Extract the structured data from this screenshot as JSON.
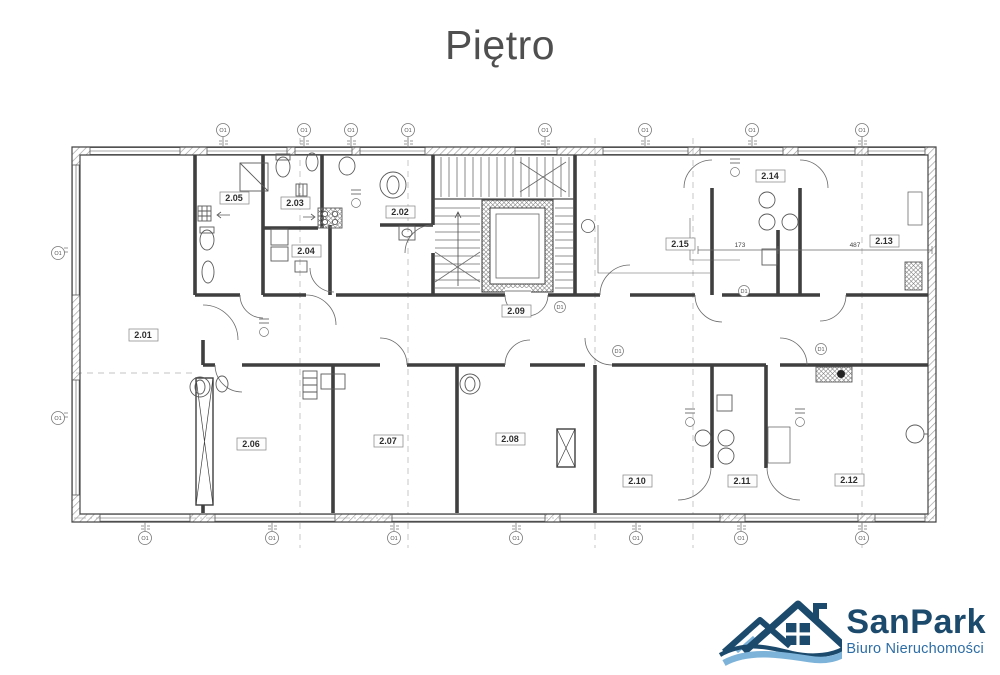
{
  "page": {
    "title": "Piętro"
  },
  "plan": {
    "rooms": [
      {
        "id": "2.01"
      },
      {
        "id": "2.02"
      },
      {
        "id": "2.03"
      },
      {
        "id": "2.04"
      },
      {
        "id": "2.05"
      },
      {
        "id": "2.06"
      },
      {
        "id": "2.07"
      },
      {
        "id": "2.08"
      },
      {
        "id": "2.09"
      },
      {
        "id": "2.10"
      },
      {
        "id": "2.11"
      },
      {
        "id": "2.12"
      },
      {
        "id": "2.13"
      },
      {
        "id": "2.14"
      },
      {
        "id": "2.15"
      }
    ],
    "window_markers_top": [
      "O1",
      "O1",
      "O1",
      "O1",
      "O1",
      "O1",
      "O1",
      "O1"
    ],
    "window_markers_bottom": [
      "O1",
      "O1",
      "O1",
      "O1",
      "O1",
      "O1",
      "O1"
    ],
    "window_markers_left": [
      "O1",
      "O1"
    ],
    "door_markers": [
      "D1",
      "D1",
      "D1",
      "D1"
    ],
    "dimension_labels": {
      "d1": "173",
      "d2": "487"
    }
  },
  "logo": {
    "name": "SanPark",
    "subtitle": "Biuro Nieruchomości"
  },
  "colors": {
    "navy": "#1b4a6d",
    "light_blue": "#7db3d9",
    "plan_line": "#454545",
    "title_gray": "#4f4f4f"
  }
}
